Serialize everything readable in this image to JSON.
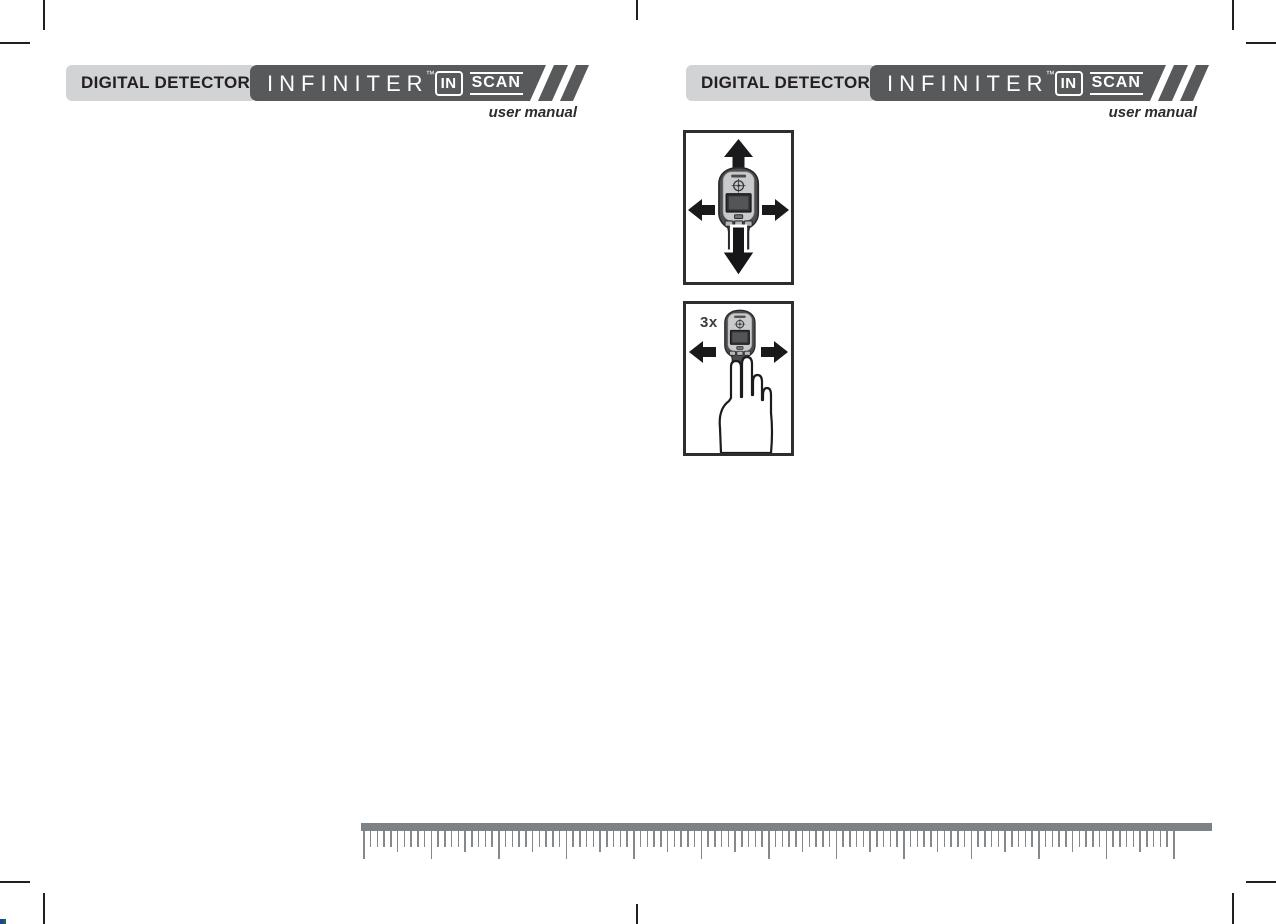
{
  "header": {
    "product_label": "DIGITAL DETECTOR",
    "brand": "INFINITER",
    "trademark": "™",
    "logo": {
      "in": "IN",
      "scan": "SCAN"
    },
    "tagline": "user manual"
  },
  "figures": {
    "scan_repeat_label": "3x"
  },
  "ruler": {
    "tick_count": 121,
    "minor_spacing": 6.75,
    "start_offset": 2,
    "major_every": 10,
    "medium_every": 5
  },
  "colors": {
    "page_bg": "#ffffff",
    "ink": "#231f20",
    "banner_light": "#d2d3d5",
    "banner_dark": "#58595b",
    "box_border": "#2e2e30",
    "arrow_black": "#1a1a1c",
    "ruler_gray": "#7d8286"
  }
}
